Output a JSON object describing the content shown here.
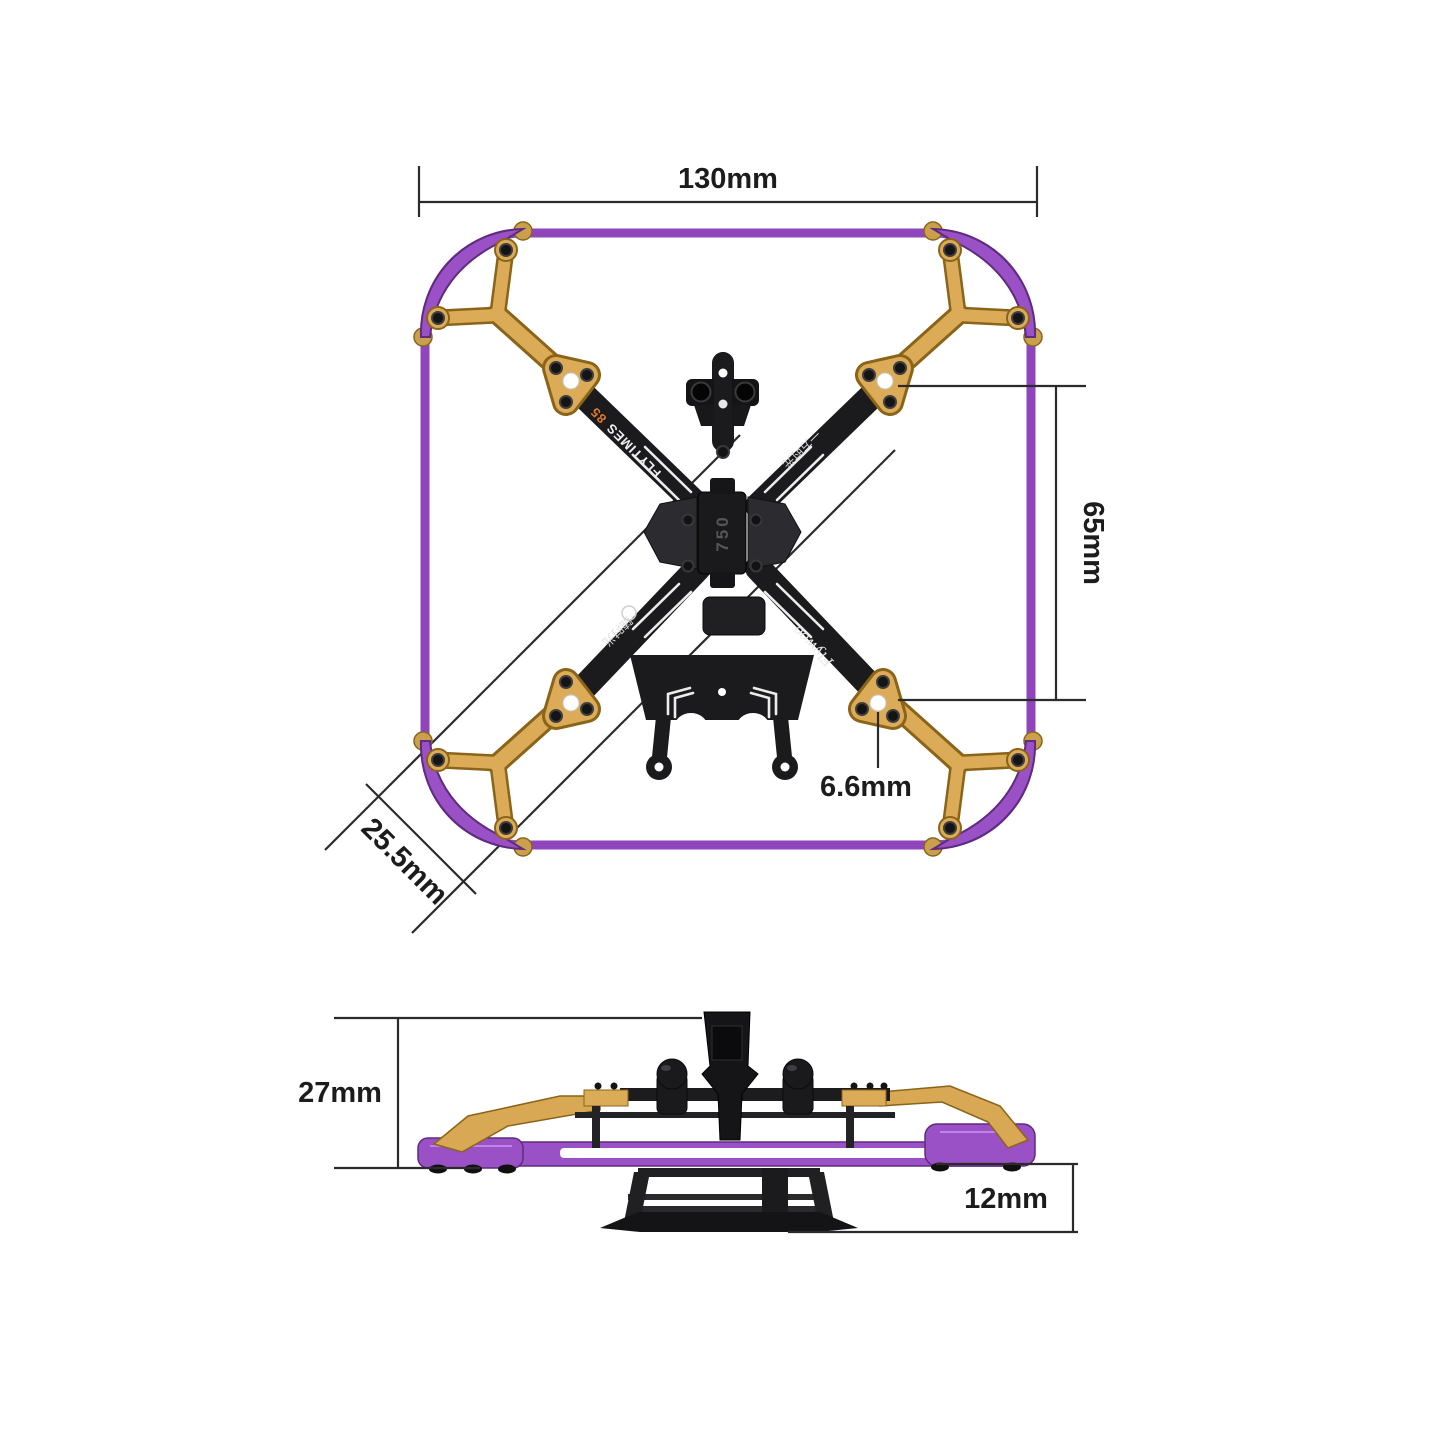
{
  "top_view": {
    "dim_width": "130mm",
    "dim_motor_spacing": "65mm",
    "dim_hole": "6.6mm",
    "dim_corner": "25.5mm",
    "marking_brand": "FLYTIMES",
    "marking_model": "85",
    "marking_center": "750",
    "marking_cn_right": "一方时光",
    "marking_cn_left": "随时光",
    "marking_logo": "Flywoo"
  },
  "side_view": {
    "dim_height": "27mm",
    "dim_clearance": "12mm"
  },
  "colors": {
    "frame_purple": "#9b51c6",
    "frame_purple_dark": "#5e2b7e",
    "arm_gold": "#dcab58",
    "gold_dark": "#8a6418",
    "carbon_black": "#1b1b1d",
    "accent_orange": "#e07a28",
    "dimension_line": "#2b2b2b",
    "background": "#ffffff"
  }
}
